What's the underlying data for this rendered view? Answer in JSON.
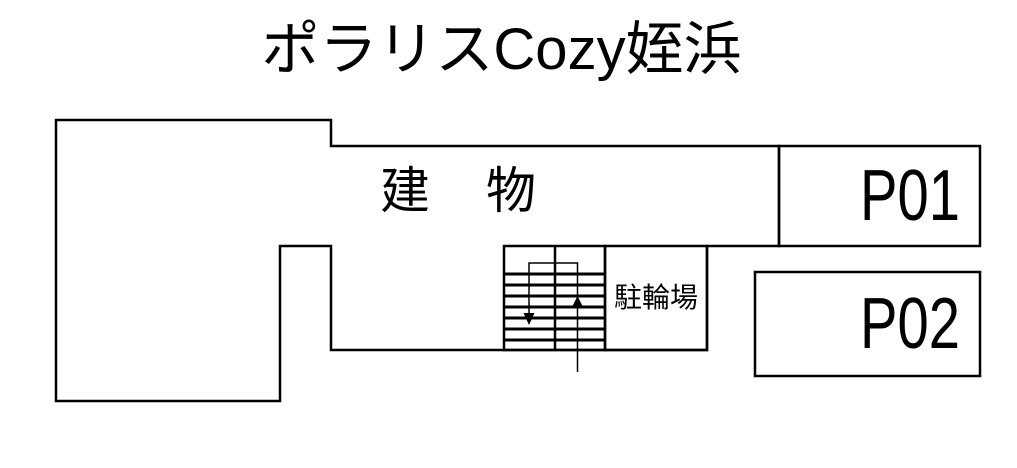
{
  "title": {
    "text": "ポラリスCozy姪浜"
  },
  "building": {
    "label": "建　物"
  },
  "bicycle_parking": {
    "label": "駐輪場"
  },
  "parking_spaces": [
    {
      "label": "P01"
    },
    {
      "label": "P02"
    }
  ],
  "stairs": {
    "up_arrow_icon": "up-arrow",
    "down_arrow_icon": "down-arrow"
  },
  "colors": {
    "background": "#ffffff",
    "line": "#000000",
    "text": "#000000"
  }
}
